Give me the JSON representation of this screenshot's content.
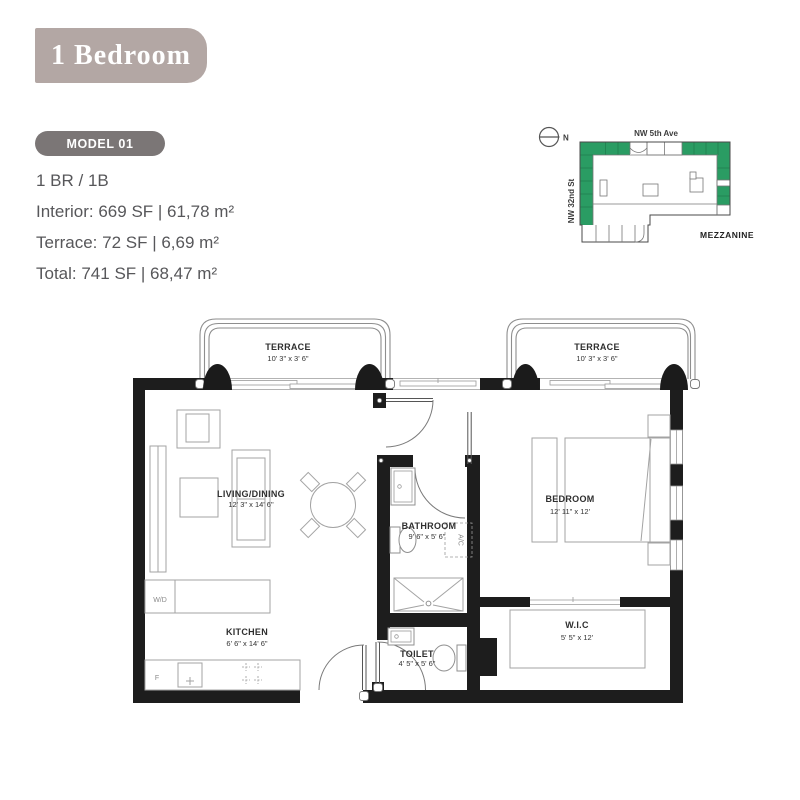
{
  "header": {
    "title": "1 Bedroom",
    "model_badge": "MODEL 01",
    "unit_type": "1 BR / 1B",
    "interior": "Interior: 669 SF | 61,78 m²",
    "terrace": "Terrace: 72 SF | 6,69 m²",
    "total": "Total: 741 SF | 68,47 m²"
  },
  "site_plan": {
    "north_label": "N",
    "street_top": "NW 5th Ave",
    "street_left": "NW 32nd St",
    "level_label": "MEZZANINE",
    "highlight_color": "#2a9c63"
  },
  "floor_plan": {
    "terrace_left": {
      "name": "TERRACE",
      "dims": "10' 3\" x 3' 6\""
    },
    "terrace_right": {
      "name": "TERRACE",
      "dims": "10' 3\" x 3' 6\""
    },
    "living": {
      "name": "LIVING/DINING",
      "dims": "12' 3\" x 14' 6\""
    },
    "kitchen": {
      "name": "KITCHEN",
      "dims": "6' 6\" x 14' 6\""
    },
    "bathroom": {
      "name": "BATHROOM",
      "dims": "9' 6\" x 5' 6\""
    },
    "toilet": {
      "name": "TOILET",
      "dims": "4' 5\" x 5' 6\""
    },
    "bedroom": {
      "name": "BEDROOM",
      "dims": "12' 11\" x 12'"
    },
    "wic": {
      "name": "W.I.C",
      "dims": "5' 5\" x 12'"
    },
    "washer_dryer": "W/D",
    "fridge": "F",
    "ac": "A/C"
  },
  "colors": {
    "title_box": "#b3a7a4",
    "badge": "#7b7676",
    "info_text": "#57575a",
    "walls": "#1d1d1d",
    "site_highlight": "#2a9c63"
  }
}
